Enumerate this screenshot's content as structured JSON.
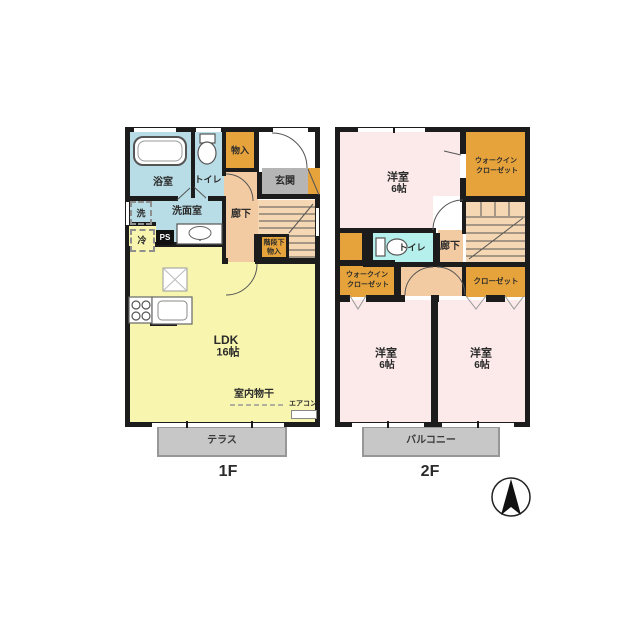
{
  "colors": {
    "wall": "#1c1c1c",
    "water_rooms_blue": "#b9dde6",
    "toilet_2f_cyan": "#b5f0ec",
    "closet_orange": "#e6a33c",
    "entrance_gray": "#b5b5b5",
    "hallway_peach": "#f3cba3",
    "stairs_peach": "#f6d7b3",
    "ldk_yellow": "#f8f6ae",
    "bedroom_pink": "#fbeae9",
    "outdoor_gray": "#c7c7c7"
  },
  "floor1": {
    "label": "1F",
    "bath": "浴室",
    "toilet": "トイレ",
    "storage": "物入",
    "entrance": "玄関",
    "washroom": "洗面室",
    "washer": "洗",
    "fridge": "冷",
    "pipe_space": "PS",
    "hallway": "廊下",
    "understairs_line1": "階段下",
    "understairs_line2": "物入",
    "ldk": "LDK",
    "ldk_size": "16帖",
    "indoor_drying": "室内物干",
    "aircon": "エアコン",
    "terrace": "テラス"
  },
  "floor2": {
    "label": "2F",
    "bedroom_main": "洋室",
    "bedroom_main_size": "6帖",
    "wic_top_line1": "ウォークイン",
    "wic_top_line2": "クローゼット",
    "toilet": "トイレ",
    "hallway": "廊下",
    "wic_mid_line1": "ウォークイン",
    "wic_mid_line2": "クローゼット",
    "closet": "クローゼット",
    "bedroom_left": "洋室",
    "bedroom_left_size": "6帖",
    "bedroom_right": "洋室",
    "bedroom_right_size": "6帖",
    "balcony": "バルコニー"
  }
}
